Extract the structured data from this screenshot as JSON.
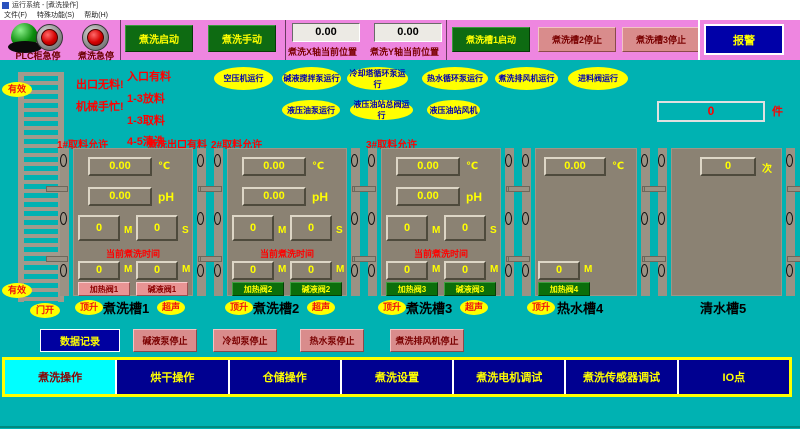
{
  "window": {
    "title": "运行系统 - [煮洗操作]",
    "menu_file": "文件(F)",
    "menu_special": "特殊功能(S)",
    "menu_help": "帮助(H)"
  },
  "topbar": {
    "estop1_label": "PLC柜急停",
    "estop2_label": "煮洗急停",
    "start_button": "煮洗启动",
    "manual_button": "煮洗手动",
    "x_pos": {
      "value": "0.00",
      "label": "煮洗X轴当前位置"
    },
    "y_pos": {
      "value": "0.00",
      "label": "煮洗Y轴当前位置"
    },
    "tank1_button": "煮洗槽1启动",
    "tank2_button": "煮洗槽2停止",
    "tank3_button": "煮洗槽3停止",
    "alarm_button": "报警"
  },
  "status": {
    "valid_top": "有效",
    "valid_bottom": "有效",
    "door_open": "门开",
    "exit_empty": "出口无料!",
    "robot_busy": "机械手忙!",
    "steps": [
      "入口有料",
      "1-3放料",
      "1-3取料",
      "4-5清洗"
    ]
  },
  "indicators": {
    "row1": [
      "空压机运行",
      "碱液搅拌泵运行",
      "冷却塔循环泵运行",
      "热水循环泵运行",
      "煮洗排风机运行",
      "进料阀运行"
    ],
    "row2": [
      "液压油泵运行",
      "液压油站总阀运行",
      "液压油站风机"
    ]
  },
  "counter": {
    "value": "0",
    "unit": "件"
  },
  "tank_headers": [
    "1#取料允许",
    "煮洗出口有料",
    "2#取料允许",
    "3#取料允许"
  ],
  "tanks": [
    {
      "name": "煮洗槽1",
      "temp": "0.00",
      "temp_unit": "℃",
      "ph": "0.00",
      "ph_unit": "pH",
      "set_min": "0",
      "set_min_unit": "M",
      "set_sec": "0",
      "set_sec_unit": "S",
      "time_label": "当前煮洗时间",
      "cur_v1": "0",
      "cur_u1": "M",
      "cur_v2": "0",
      "cur_u2": "M",
      "heat_valve": "加热阀1",
      "alkali_valve": "碱液阀1",
      "lift": "顶升",
      "ultrasonic": "超声"
    },
    {
      "name": "煮洗槽2",
      "temp": "0.00",
      "temp_unit": "℃",
      "ph": "0.00",
      "ph_unit": "pH",
      "set_min": "0",
      "set_min_unit": "M",
      "set_sec": "0",
      "set_sec_unit": "S",
      "time_label": "当前煮洗时间",
      "cur_v1": "0",
      "cur_u1": "M",
      "cur_v2": "0",
      "cur_u2": "M",
      "heat_valve": "加热阀2",
      "alkali_valve": "碱液阀2",
      "lift": "顶升",
      "ultrasonic": "超声"
    },
    {
      "name": "煮洗槽3",
      "temp": "0.00",
      "temp_unit": "℃",
      "ph": "0.00",
      "ph_unit": "pH",
      "set_min": "0",
      "set_min_unit": "M",
      "set_sec": "0",
      "set_sec_unit": "S",
      "time_label": "当前煮洗时间",
      "cur_v1": "0",
      "cur_u1": "M",
      "cur_v2": "0",
      "cur_u2": "M",
      "heat_valve": "加热阀3",
      "alkali_valve": "碱液阀3",
      "lift": "顶升",
      "ultrasonic": "超声"
    },
    {
      "name": "热水槽4",
      "temp": "0.00",
      "temp_unit": "℃",
      "cur_v1": "0",
      "cur_u1": "M",
      "heat_valve": "加热阀4",
      "lift": "顶升"
    },
    {
      "name": "清水槽5",
      "count": "0",
      "count_unit": "次"
    }
  ],
  "action_buttons": {
    "data_log": "数据记录",
    "alkali_pump": "碱液泵停止",
    "cooling_pump": "冷却泵停止",
    "hot_water_pump": "热水泵停止",
    "exhaust_fan": "煮洗排风机停止"
  },
  "nav_tabs": [
    "煮洗操作",
    "烘干操作",
    "仓储操作",
    "煮洗设置",
    "煮洗电机调试",
    "煮洗传感器调试",
    "IO点"
  ],
  "colors": {
    "background": "#00b2b2",
    "topbar": "#ee86e0",
    "tank_body": "#8b8273",
    "running_green": "#0e6b12",
    "stopped_pink": "#d98c8c",
    "navy": "#0000a0",
    "indicator_yellow": "#ffff00",
    "alert_red": "#ff0000",
    "active_tab_cyan": "#00ffff"
  }
}
